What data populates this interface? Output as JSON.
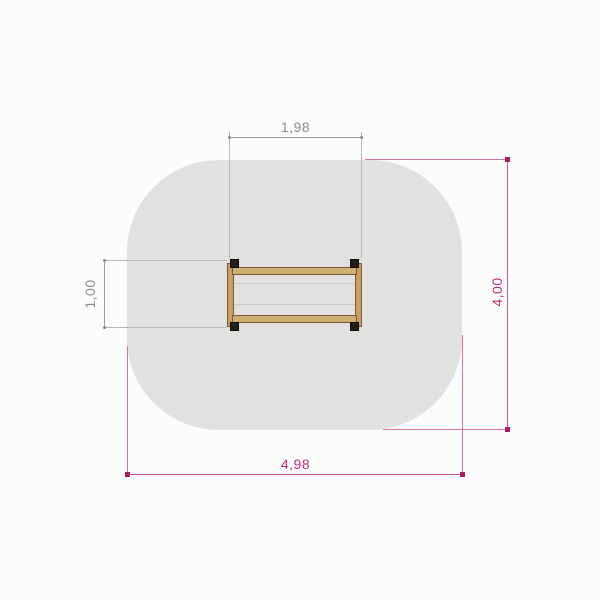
{
  "drawing": {
    "safety_area": {
      "fill": "#e1e1e0",
      "width_label": "4,98",
      "height_label": "4,00"
    },
    "equipment": {
      "wood_fill": "#cfae74",
      "wood_border": "#7a5733",
      "post_color": "#231e18",
      "width_label": "1,98",
      "depth_label": "1,00"
    },
    "dimensions": {
      "top": {
        "label": "1,98",
        "orientation": "horizontal",
        "color": "#8c8c8c"
      },
      "left": {
        "label": "1,00",
        "orientation": "vertical",
        "color": "#8c8c8c"
      },
      "right": {
        "label": "4,00",
        "orientation": "vertical",
        "color": "#c22a78"
      },
      "bottom": {
        "label": "4,98",
        "orientation": "horizontal",
        "color": "#c22a78"
      }
    },
    "palette": {
      "dimension_gray": "#8c8c8c",
      "dimension_magenta": "#c22a78",
      "background": "#fcfcfb"
    }
  }
}
